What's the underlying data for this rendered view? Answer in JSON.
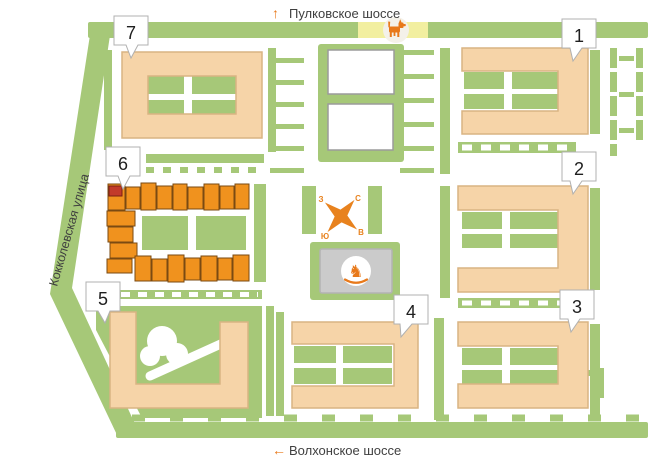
{
  "streets": {
    "north": {
      "label": "Пулковское шоссе",
      "arrow": "↑"
    },
    "south": {
      "label": "Волхонское шоссе",
      "arrow": "←"
    },
    "west": {
      "label": "Кокколевская улица"
    }
  },
  "buildings": [
    {
      "number": "1"
    },
    {
      "number": "2"
    },
    {
      "number": "3"
    },
    {
      "number": "4"
    },
    {
      "number": "5"
    },
    {
      "number": "6",
      "highlighted": true
    },
    {
      "number": "7"
    }
  ],
  "compass": {
    "north": "С",
    "south": "Ю",
    "east": "В",
    "west": "З"
  },
  "amenities": {
    "dog_walking_area": "dog-icon",
    "playground": "rocking-horse-icon"
  },
  "colors": {
    "green_area": "#A6C878",
    "building": "#F6D4A8",
    "selected_building": "#F0921E",
    "sold_section": "#C23B2A",
    "dog_area_strip": "#F2EFA0",
    "playground_pad": "#CBCBCB",
    "accent_orange": "#E8791A",
    "street_text": "#3F3F3F"
  }
}
